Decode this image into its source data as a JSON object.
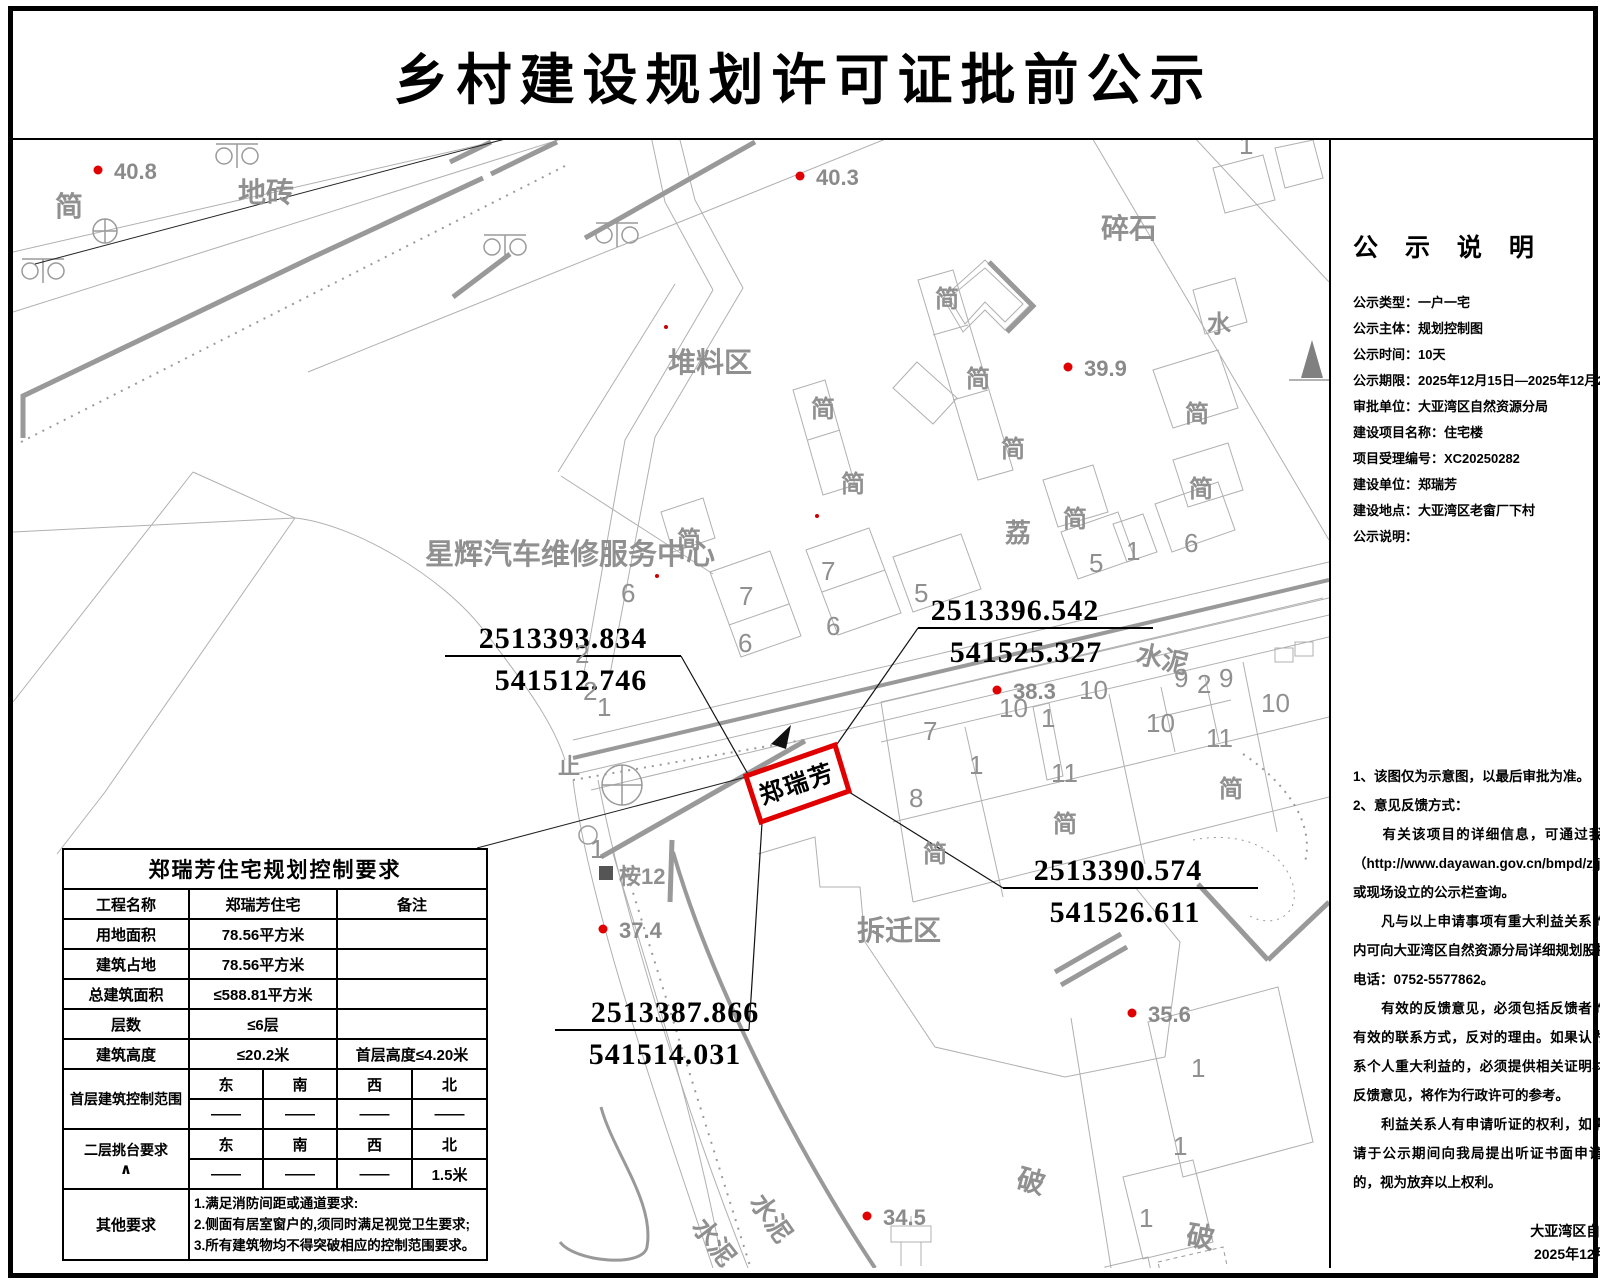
{
  "title": "乡村建设规划许可证批前公示",
  "sidebar": {
    "heading": "公 示 说 明",
    "fields": [
      {
        "label": "公示类型：",
        "value": "一户一宅"
      },
      {
        "label": "公示主体：",
        "value": "规划控制图"
      },
      {
        "label": "公示时间：",
        "value": "10天"
      },
      {
        "label": "公示期限：",
        "value": "2025年12月15日—2025年12月24日"
      },
      {
        "label": "审批单位：",
        "value": "大亚湾区自然资源分局"
      },
      {
        "label": "建设项目名称：",
        "value": "住宅楼"
      },
      {
        "label": "项目受理编号：",
        "value": "XC20250282"
      },
      {
        "label": "建设单位：",
        "value": "郑瑞芳"
      },
      {
        "label": "建设地点：",
        "value": "大亚湾区老畲厂下村"
      },
      {
        "label": "公示说明：",
        "value": ""
      }
    ],
    "notes": [
      "1、该图仅为示意图，以最后审批为准。",
      "2、意见反馈方式：",
      "　　有关该项目的详细信息，可通过我局规划网站（http://www.dayawan.gov.cn/bmpd/zjj/index.html)或现场设立的公示栏查询。",
      "　　凡与以上申请事项有重大利益关系的，在公示期内可向大亚湾区自然资源分局详细规划股提出意见。",
      "电话：0752-5577862。",
      "　　有效的反馈意见，必须包括反馈者的真实姓名，有效的联系方式，反对的理由。如果认为申请事项关系个人重大利益的，必须提供相关证明材料。有效的反馈意见，将作为行政许可的参考。",
      "　　利益关系人有申请听证的权利，如需申请听证，请于公示期间向我局提出听证书面申请，逾期提出的，视为放弃以上权利。"
    ],
    "signature": "大亚湾区自然资源分局",
    "date": "2025年12月15日"
  },
  "table": {
    "title": "郑瑞芳住宅规划控制要求",
    "rows": [
      {
        "label": "工程名称",
        "value": "郑瑞芳住宅",
        "note": "备注"
      },
      {
        "label": "用地面积",
        "value": "78.56平方米",
        "note": ""
      },
      {
        "label": "建筑占地",
        "value": "78.56平方米",
        "note": ""
      },
      {
        "label": "总建筑面积",
        "value": "≤588.81平方米",
        "note": ""
      },
      {
        "label": "层数",
        "value": "≤6层",
        "note": ""
      },
      {
        "label": "建筑高度",
        "value": "≤20.2米",
        "note": "首层高度≤4.20米"
      }
    ],
    "dir_groups": [
      {
        "label": "首层建筑控制范围",
        "sub": "",
        "dirs": [
          "东",
          "南",
          "西",
          "北"
        ],
        "vals": [
          "——",
          "——",
          "——",
          "——"
        ]
      },
      {
        "label": "二层挑台要求",
        "sub": "∧",
        "dirs": [
          "东",
          "南",
          "西",
          "北"
        ],
        "vals": [
          "——",
          "——",
          "——",
          "1.5米"
        ]
      }
    ],
    "other": {
      "label": "其他要求",
      "lines": [
        "1.满足消防间距或通道要求:",
        "2.侧面有居室窗户的,须同时满足视觉卫生要求;",
        "3.所有建筑物均不得突破相应的控制范围要求。"
      ]
    }
  },
  "map": {
    "plot": {
      "label": "郑瑞芳"
    },
    "callouts": [
      {
        "n": "2513393.834",
        "e": "541512.746",
        "tx": 550,
        "ex": 558,
        "ux1": 432,
        "ux2": 668,
        "uy": 516,
        "leader": "668,516 736,636"
      },
      {
        "n": "2513396.542",
        "e": "541525.327",
        "tx": 1002,
        "ex": 1013,
        "ux1": 905,
        "ux2": 1140,
        "uy": 488,
        "leader": "905,488 822,607",
        "arrow": "758,604 778,585 773,609"
      },
      {
        "n": "2513387.866",
        "e": "541514.031",
        "tx": 662,
        "ex": 652,
        "ux1": 542,
        "ux2": 736,
        "uy": 890,
        "leader": "736,890 749,683"
      },
      {
        "n": "2513390.574",
        "e": "541526.611",
        "tx": 1105,
        "ex": 1112,
        "ux1": 990,
        "ux2": 1245,
        "uy": 748,
        "leader": "990,748 836,652"
      }
    ],
    "elevations": [
      {
        "v": "40.8",
        "x": 85,
        "y": 30
      },
      {
        "v": "40.3",
        "x": 787,
        "y": 36
      },
      {
        "v": "39.9",
        "x": 1055,
        "y": 227
      },
      {
        "v": "38.3",
        "x": 984,
        "y": 550
      },
      {
        "v": "37.4",
        "x": 590,
        "y": 789
      },
      {
        "v": "35.6",
        "x": 1119,
        "y": 873
      },
      {
        "v": "34.5",
        "x": 854,
        "y": 1076
      }
    ],
    "labels": [
      {
        "t": "简",
        "x": 42,
        "y": 76,
        "s": 28
      },
      {
        "t": "地砖",
        "x": 225,
        "y": 62,
        "s": 28
      },
      {
        "t": "碎石",
        "x": 1088,
        "y": 98,
        "s": 28
      },
      {
        "t": "堆料区",
        "x": 655,
        "y": 232,
        "s": 28
      },
      {
        "t": "简",
        "x": 922,
        "y": 167,
        "s": 24
      },
      {
        "t": "简",
        "x": 953,
        "y": 247,
        "s": 24
      },
      {
        "t": "简",
        "x": 988,
        "y": 317,
        "s": 24
      },
      {
        "t": "简",
        "x": 798,
        "y": 277,
        "s": 24
      },
      {
        "t": "简",
        "x": 828,
        "y": 352,
        "s": 24
      },
      {
        "t": "水",
        "x": 1194,
        "y": 192,
        "s": 24
      },
      {
        "t": "简",
        "x": 1172,
        "y": 282,
        "s": 24
      },
      {
        "t": "星辉汽车维修服务中心",
        "x": 412,
        "y": 424,
        "s": 29
      },
      {
        "t": "简",
        "x": 664,
        "y": 408,
        "s": 24
      },
      {
        "t": "荔",
        "x": 992,
        "y": 402,
        "s": 26
      },
      {
        "t": "简",
        "x": 1050,
        "y": 387,
        "s": 24
      },
      {
        "t": "简",
        "x": 1176,
        "y": 357,
        "s": 24
      },
      {
        "t": "水泥",
        "x": 1122,
        "y": 522,
        "s": 26,
        "r": 13
      },
      {
        "t": "止",
        "x": 545,
        "y": 634,
        "s": 22
      },
      {
        "t": "桉12",
        "x": 606,
        "y": 744,
        "s": 22
      },
      {
        "t": "简",
        "x": 910,
        "y": 722,
        "s": 24
      },
      {
        "t": "简",
        "x": 1040,
        "y": 692,
        "s": 24
      },
      {
        "t": "简",
        "x": 1206,
        "y": 657,
        "s": 24
      },
      {
        "t": "拆迁区",
        "x": 844,
        "y": 800,
        "s": 28
      },
      {
        "t": "水泥",
        "x": 678,
        "y": 1087,
        "s": 26,
        "r": 52
      },
      {
        "t": "水泥",
        "x": 736,
        "y": 1062,
        "s": 26,
        "r": 55
      },
      {
        "t": "破",
        "x": 1002,
        "y": 1047,
        "s": 28,
        "r": 15
      },
      {
        "t": "破",
        "x": 1172,
        "y": 1104,
        "s": 28,
        "r": 10
      }
    ],
    "numbers": [
      {
        "t": "6",
        "x": 608,
        "y": 462
      },
      {
        "t": "7",
        "x": 726,
        "y": 465
      },
      {
        "t": "6",
        "x": 725,
        "y": 512
      },
      {
        "t": "7",
        "x": 808,
        "y": 440
      },
      {
        "t": "6",
        "x": 813,
        "y": 495
      },
      {
        "t": "5",
        "x": 901,
        "y": 462
      },
      {
        "t": "5",
        "x": 1076,
        "y": 432
      },
      {
        "t": "1",
        "x": 1113,
        "y": 420
      },
      {
        "t": "6",
        "x": 1171,
        "y": 412
      },
      {
        "t": "2",
        "x": 562,
        "y": 523
      },
      {
        "t": "2",
        "x": 570,
        "y": 560
      },
      {
        "t": "1",
        "x": 584,
        "y": 576
      },
      {
        "t": "1",
        "x": 577,
        "y": 718
      },
      {
        "t": "9",
        "x": 1161,
        "y": 547
      },
      {
        "t": "2",
        "x": 1184,
        "y": 553
      },
      {
        "t": "9",
        "x": 1206,
        "y": 547
      },
      {
        "t": "10",
        "x": 986,
        "y": 577
      },
      {
        "t": "10",
        "x": 1066,
        "y": 559
      },
      {
        "t": "1",
        "x": 1028,
        "y": 587
      },
      {
        "t": "10",
        "x": 1133,
        "y": 592
      },
      {
        "t": "10",
        "x": 1248,
        "y": 572
      },
      {
        "t": "11",
        "x": 1193,
        "y": 607
      },
      {
        "t": "7",
        "x": 910,
        "y": 600
      },
      {
        "t": "1",
        "x": 956,
        "y": 634
      },
      {
        "t": "11",
        "x": 1038,
        "y": 642
      },
      {
        "t": "8",
        "x": 896,
        "y": 667
      },
      {
        "t": "1",
        "x": 1178,
        "y": 937
      },
      {
        "t": "1",
        "x": 1160,
        "y": 1015
      },
      {
        "t": "1",
        "x": 1126,
        "y": 1087
      },
      {
        "t": "1",
        "x": 1226,
        "y": 14
      }
    ]
  }
}
